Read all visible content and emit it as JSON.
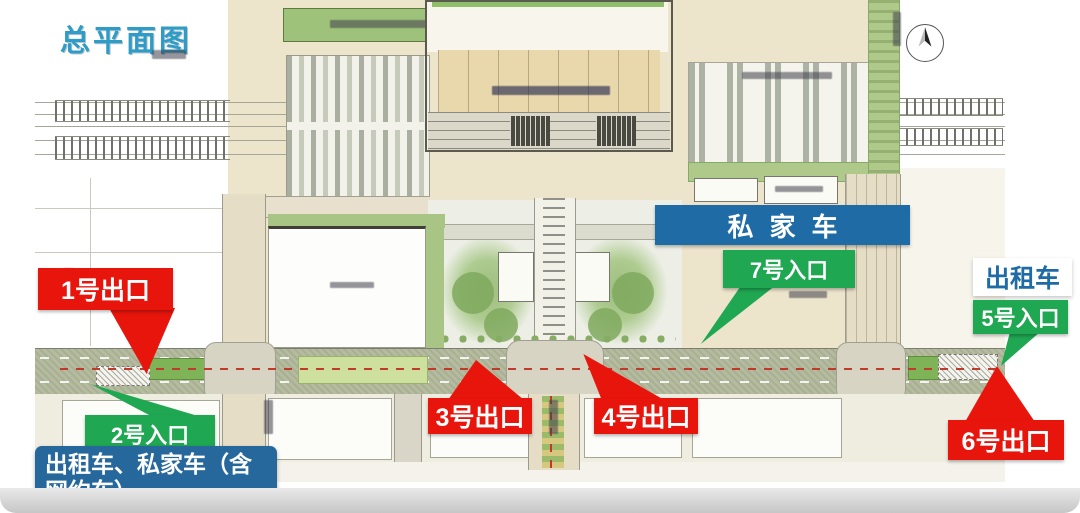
{
  "title": {
    "text": "总平面图"
  },
  "colors": {
    "title_teal": "#2E9CC6",
    "zone_blue": "#1E6BA6",
    "note_blue": "#26689B",
    "entrance_green": "#1FA752",
    "exit_red": "#E8150C",
    "taxi_text_blue": "#1E6BA6"
  },
  "zones": {
    "private_car": {
      "label": "私家车"
    },
    "taxi": {
      "label": "出租车"
    }
  },
  "entrances": [
    {
      "id": 2,
      "label": "2号入口"
    },
    {
      "id": 5,
      "label": "5号入口"
    },
    {
      "id": 7,
      "label": "7号入口"
    }
  ],
  "exits": [
    {
      "id": 1,
      "label": "1号出口"
    },
    {
      "id": 3,
      "label": "3号出口"
    },
    {
      "id": 4,
      "label": "4号出口"
    },
    {
      "id": 6,
      "label": "6号出口"
    }
  ],
  "note": {
    "text": "出租车、私家车（含网约车）"
  },
  "icons": {
    "compass": "compass-rose-icon"
  }
}
